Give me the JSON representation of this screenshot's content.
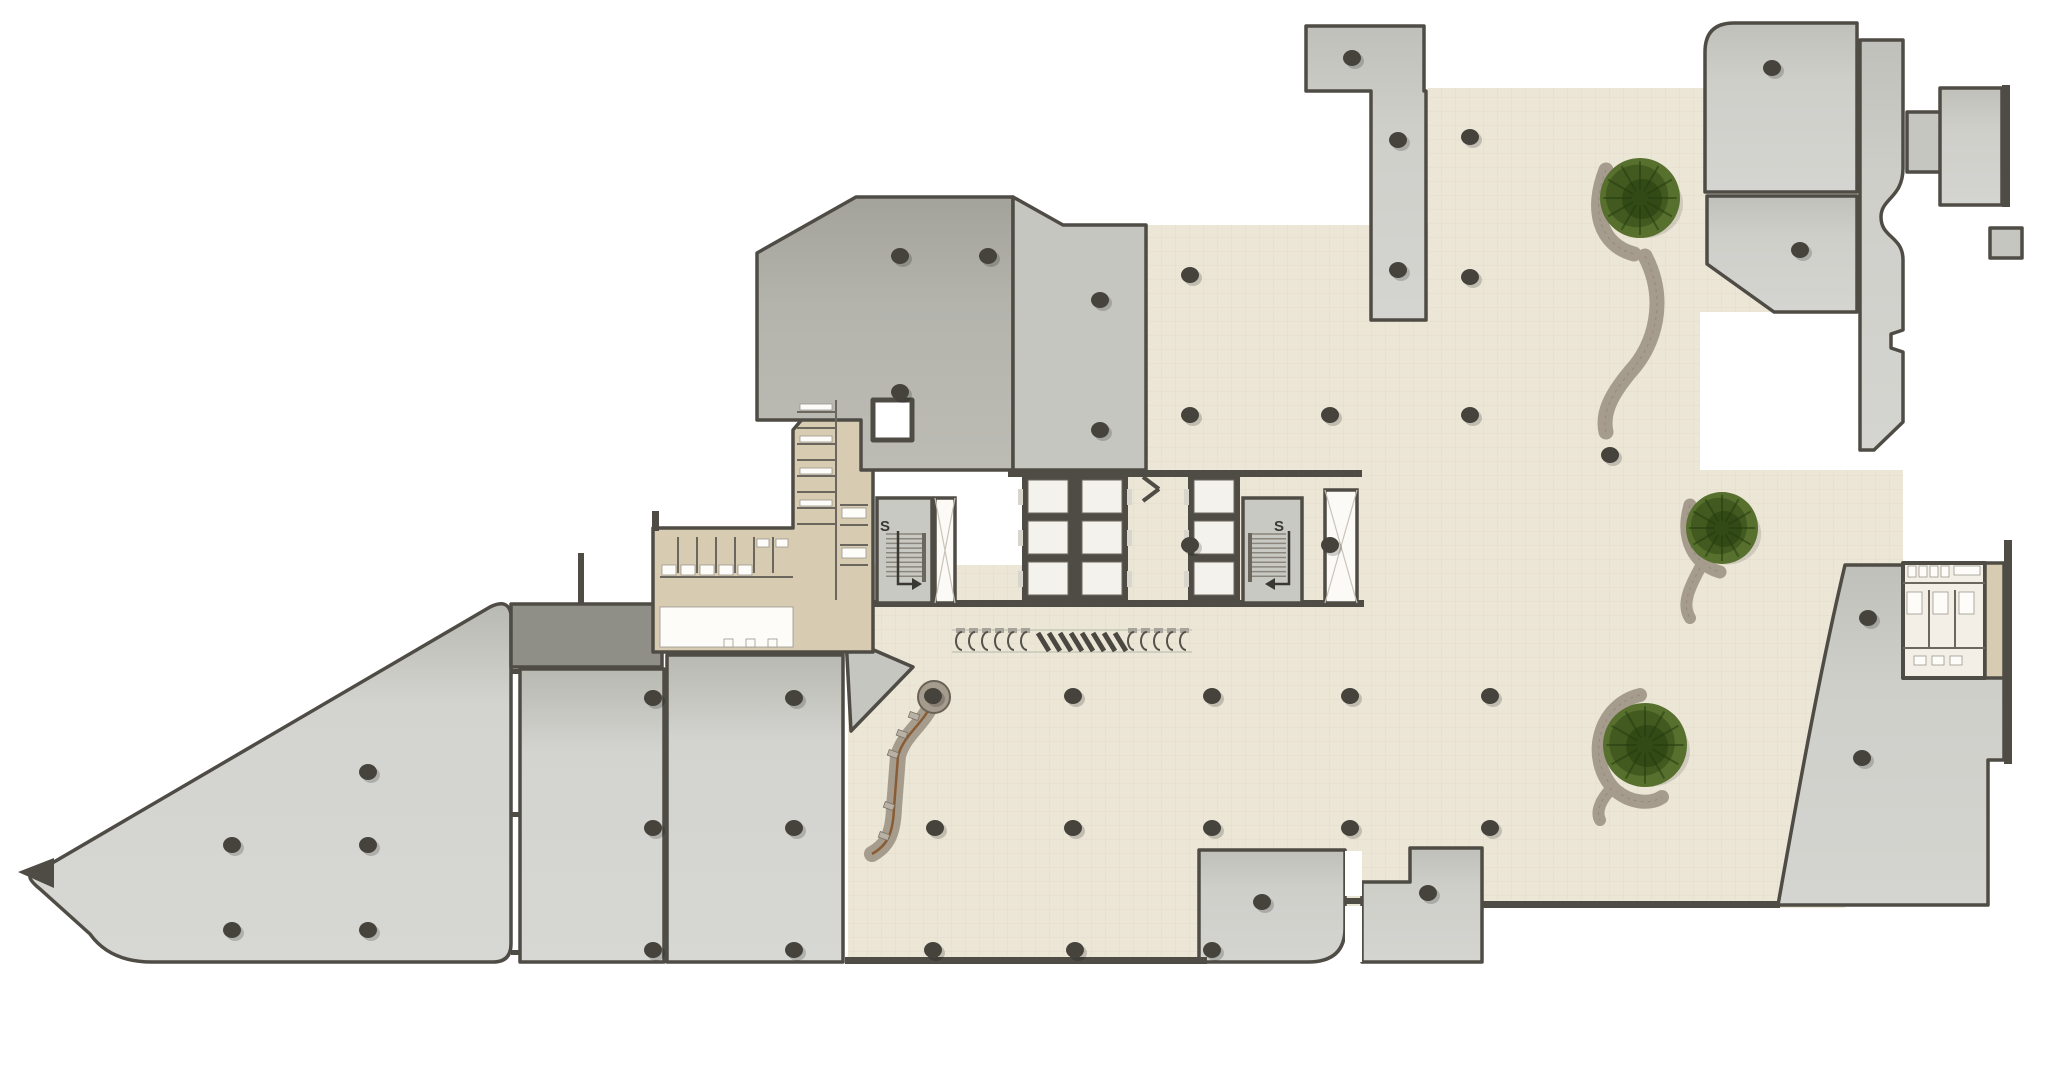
{
  "labels": {
    "stair_left": "S",
    "stair_right": "S"
  },
  "palette": {
    "background": "#ffffff",
    "wall": "#4f4c45",
    "room_light": "#d3d3cf",
    "room_mid": "#c6c6c1",
    "room_dark_band": "#8f8f88",
    "room_top_cluster": "#b4b4ad",
    "beige": "#ece6d7",
    "beige_grid": "#d9d0ba",
    "tan": "#d7cbb2",
    "white_room": "#f3efe6",
    "tree_green_outer": "#57702d",
    "tree_green_mid": "#42591f",
    "tree_green_dark": "#324a15",
    "planter_gray": "#a69c8e",
    "path_brown": "#8a5c33",
    "column": "#45433c"
  },
  "plan": {
    "canvas": {
      "w": 2048,
      "h": 1078
    },
    "floor_zones": [
      {
        "name": "concourse-top-arm",
        "d": "M1146,225 L1428,225 L1428,88 L1700,88 L1700,470 L1146,470 Z"
      },
      {
        "name": "concourse-top-right",
        "d": "M1700,88 L1857,88 L1857,312 L1700,312 Z"
      },
      {
        "name": "concourse-mid-band",
        "d": "M1128,470 L1903,470 L1903,565 L1128,565 Z"
      },
      {
        "name": "concourse-core-gap-1",
        "d": "M1128,565 L1188,565 L1188,605 L1128,605 Z"
      },
      {
        "name": "concourse-core-gap-2",
        "d": "M1302,565 L1325,565 L1325,605 L1302,605 Z"
      },
      {
        "name": "concourse-gate-strip",
        "d": "M843,603 L1199,603 L1199,655 L843,655 Z"
      },
      {
        "name": "concourse-main",
        "d": "M848,565 L1845,565 L1845,908 L848,908 Z"
      },
      {
        "name": "concourse-south",
        "d": "M848,655 L1199,655 L1199,958 L848,958 Z"
      }
    ],
    "rooms": [
      {
        "name": "room-triangle-hall",
        "fill": "grad1",
        "d": "M30,876 L490,607 Q508,598 511,614 L511,944 Q511,962 493,962 L152,962 Q110,962 90,934 L40,889 Q29,880 30,876 Z"
      },
      {
        "name": "triangle-tip-wall",
        "fill": "wall",
        "sw": 0,
        "d": "M18,872 L54,858 L54,888 Z"
      },
      {
        "name": "room-dark-band",
        "fill": "dark_band",
        "d": "M511,604 L662,604 L662,667 L511,667 Z"
      },
      {
        "name": "room-a",
        "fill": "grad1",
        "d": "M520,669 L664,669 L664,962 L520,962 Z"
      },
      {
        "name": "room-b",
        "fill": "grad1",
        "d": "M667,655 L843,655 L843,962 L667,962 Z"
      },
      {
        "name": "room-sliver-point",
        "fill": "room_mid",
        "d": "M846,638 L913,667 L851,731 Z"
      },
      {
        "name": "room-restroom-left-block",
        "fill": "tan",
        "d": "M653,528 L793,528 L793,430 L820,398 L873,398 L873,652 L653,652 Z"
      },
      {
        "name": "room-top-cluster-main",
        "fill": "grad2",
        "d": "M757,253 L856,197 L1013,197 L1013,470 L861,470 L861,420 L757,420 Z"
      },
      {
        "name": "room-top-cluster-right",
        "fill": "room_mid",
        "d": "M1013,197 L1063,225 L1146,225 L1146,470 L1013,470 Z"
      },
      {
        "name": "room-tower-slab",
        "fill": "grad3",
        "d": "M1306,26 L1424,26 L1424,91 L1426,91 L1426,320 L1371,320 L1371,91 L1306,91 Z"
      },
      {
        "name": "room-northeast-1",
        "fill": "grad3",
        "d": "M1705,52 Q1705,23 1734,23 L1857,23 L1857,192 L1705,192 Z"
      },
      {
        "name": "room-northeast-2",
        "fill": "grad3",
        "d": "M1707,196 L1857,196 L1857,312 L1774,312 L1707,264 Z"
      },
      {
        "name": "room-east-violin",
        "fill": "grad3",
        "d": "M1860,40 L1903,40 L1903,168 C1903,198 1881,198 1881,217 C1881,238 1903,236 1903,260 L1903,330 L1891,334 L1891,348 L1903,352 L1903,422 L1874,450 L1860,450 Z"
      },
      {
        "name": "room-east-headbox",
        "fill": "room_mid",
        "d": "M1907,112 L1942,112 L1942,172 L1907,172 Z"
      },
      {
        "name": "room-far-right-top",
        "fill": "grad3",
        "d": "M1940,88 L2002,88 L2002,205 L1940,205 Z"
      },
      {
        "name": "room-far-right-box",
        "fill": "room_mid",
        "d": "M1990,228 L2022,228 L2022,258 L1990,258 Z"
      },
      {
        "name": "room-southeast-curved",
        "fill": "grad3",
        "d": "M1845,565 L2004,565 L2004,760 L1988,760 L1988,905 L1778,905 C1802,770 1822,662 1845,565 Z"
      },
      {
        "name": "room-south-1",
        "fill": "grad3",
        "d": "M1199,850 L1345,850 L1345,928 Q1345,962 1308,962 L1199,962 Z"
      },
      {
        "name": "room-south-2",
        "fill": "grad3",
        "d": "M1362,882 L1410,882 L1410,848 L1482,848 L1482,962 L1362,962 Z"
      },
      {
        "name": "room-restroom-right-block",
        "fill": "white_room",
        "sw": 4,
        "d": "M1903,563 L1985,563 L1985,678 L1903,678 Z"
      },
      {
        "name": "room-restroom-right-strip",
        "fill": "tan",
        "d": "M1985,563 L2004,563 L2004,678 L1985,678 Z"
      },
      {
        "name": "room-elevator-duct-box",
        "fill": "white",
        "sw": 5,
        "d": "M873,400 L912,400 L912,440 L873,440 Z"
      }
    ],
    "walls": [
      [
        872,
        600,
        492,
        7
      ],
      [
        845,
        957,
        362,
        7
      ],
      [
        1482,
        901,
        298,
        7
      ],
      [
        578,
        553,
        6,
        51
      ],
      [
        652,
        511,
        7,
        20
      ],
      [
        2002,
        85,
        8,
        122
      ],
      [
        2004,
        540,
        8,
        224
      ],
      [
        1008,
        470,
        354,
        7
      ],
      [
        511,
        669,
        9,
        5
      ],
      [
        511,
        812,
        9,
        5
      ],
      [
        511,
        950,
        9,
        5
      ],
      [
        1345,
        898,
        17,
        6
      ]
    ],
    "white_rects": [
      [
        1345,
        851,
        17,
        45
      ],
      [
        1345,
        906,
        17,
        56
      ]
    ],
    "fixture_lines": [
      [
        678,
        537,
        678,
        573
      ],
      [
        697,
        537,
        697,
        573
      ],
      [
        716,
        537,
        716,
        573
      ],
      [
        735,
        537,
        735,
        573
      ],
      [
        754,
        537,
        754,
        573
      ],
      [
        773,
        537,
        773,
        573
      ],
      [
        660,
        577,
        793,
        577
      ],
      [
        797,
        412,
        836,
        412
      ],
      [
        797,
        428,
        836,
        428
      ],
      [
        797,
        444,
        836,
        444
      ],
      [
        797,
        460,
        836,
        460
      ],
      [
        797,
        476,
        836,
        476
      ],
      [
        797,
        492,
        836,
        492
      ],
      [
        797,
        508,
        836,
        508
      ],
      [
        797,
        524,
        836,
        524
      ],
      [
        836,
        400,
        836,
        600
      ],
      [
        840,
        505,
        868,
        505
      ],
      [
        840,
        525,
        868,
        525
      ],
      [
        840,
        545,
        868,
        545
      ],
      [
        840,
        565,
        868,
        565
      ],
      [
        1903,
        583,
        1985,
        583
      ],
      [
        1903,
        648,
        1985,
        648
      ],
      [
        1929,
        590,
        1929,
        648
      ],
      [
        1955,
        590,
        1955,
        648
      ]
    ],
    "fixtures_white": [
      [
        662,
        565,
        14,
        10
      ],
      [
        681,
        565,
        14,
        10
      ],
      [
        700,
        565,
        14,
        10
      ],
      [
        719,
        565,
        14,
        10
      ],
      [
        738,
        565,
        14,
        10
      ],
      [
        757,
        539,
        12,
        8
      ],
      [
        776,
        539,
        12,
        8
      ],
      [
        660,
        607,
        133,
        40
      ],
      [
        724,
        639,
        9,
        8
      ],
      [
        746,
        639,
        9,
        8
      ],
      [
        768,
        639,
        9,
        8
      ],
      [
        800,
        404,
        32,
        6
      ],
      [
        800,
        436,
        32,
        6
      ],
      [
        800,
        468,
        32,
        6
      ],
      [
        800,
        500,
        32,
        6
      ],
      [
        842,
        508,
        24,
        10
      ],
      [
        842,
        548,
        24,
        10
      ],
      [
        1908,
        566,
        8,
        11
      ],
      [
        1919,
        566,
        8,
        11
      ],
      [
        1930,
        566,
        8,
        11
      ],
      [
        1941,
        566,
        8,
        11
      ],
      [
        1954,
        566,
        26,
        9
      ],
      [
        1907,
        592,
        15,
        22
      ],
      [
        1933,
        592,
        15,
        22
      ],
      [
        1959,
        592,
        15,
        22
      ],
      [
        1914,
        656,
        12,
        9
      ],
      [
        1932,
        656,
        12,
        9
      ],
      [
        1950,
        656,
        12,
        9
      ]
    ],
    "stairs": [
      {
        "name": "stair-left",
        "room": [
          877,
          498,
          55,
          105
        ],
        "treads_x": [
          886,
          926
        ],
        "rail_x": 922,
        "arrow_x": 898,
        "dir": 1
      },
      {
        "name": "stair-right",
        "room": [
          1243,
          498,
          59,
          105
        ],
        "treads_x": [
          1248,
          1286
        ],
        "rail_x": 1248,
        "arrow_x": 1289,
        "dir": -1
      }
    ],
    "shafts": [
      {
        "name": "shaft-left",
        "rect": [
          935,
          498,
          20,
          105
        ]
      },
      {
        "name": "shaft-right",
        "rect": [
          1325,
          490,
          32,
          113
        ]
      }
    ],
    "elevator_banks": [
      {
        "name": "elevator-bank-center",
        "x": 1022,
        "y": 473,
        "w": 106,
        "h": 130,
        "cols": 2,
        "rows": 3,
        "doors": "both"
      },
      {
        "name": "elevator-bank-east",
        "x": 1188,
        "y": 473,
        "w": 52,
        "h": 130,
        "cols": 1,
        "rows": 3,
        "doors": "left"
      }
    ],
    "chevron_wall": [
      [
        1143,
        477,
        1159,
        489
      ],
      [
        1159,
        489,
        1143,
        501
      ]
    ],
    "turnstiles": {
      "guide_y": [
        630,
        652
      ],
      "guide_x": [
        952,
        1192
      ],
      "gates_left": {
        "start": 956,
        "count": 6,
        "step": 13,
        "y": 630
      },
      "blades": {
        "start": 1038,
        "count": 8,
        "step": 11,
        "y": 633
      },
      "gates_right": {
        "start": 1128,
        "count": 5,
        "step": 13,
        "y": 630
      }
    },
    "trees": [
      {
        "name": "tree-north",
        "x": 1640,
        "y": 198,
        "r": 40
      },
      {
        "name": "tree-mid",
        "x": 1722,
        "y": 528,
        "r": 36
      },
      {
        "name": "tree-south",
        "x": 1645,
        "y": 745,
        "r": 42
      }
    ],
    "planter_paths": [
      {
        "name": "planter-north-arc",
        "d": "M1606,170 C1590,210 1600,245 1634,254",
        "w": 15
      },
      {
        "name": "planter-north-tail",
        "d": "M1645,256 C1668,300 1655,345 1630,372 C1610,396 1602,414 1606,432",
        "w": 15
      },
      {
        "name": "planter-mid-arc",
        "d": "M1690,505 C1680,540 1695,565 1720,572",
        "w": 13
      },
      {
        "name": "planter-mid-tail",
        "d": "M1700,568 C1688,590 1682,605 1690,618",
        "w": 12
      },
      {
        "name": "planter-south-arc",
        "d": "M1640,695 C1598,705 1585,760 1615,790 C1630,803 1650,805 1662,797",
        "w": 14
      },
      {
        "name": "planter-south-tail",
        "d": "M1612,788 C1600,800 1596,812 1600,820",
        "w": 12
      }
    ],
    "ramp": {
      "hub": {
        "x": 934,
        "y": 697,
        "r_outer": 16,
        "r_inner": 7
      },
      "path_d": "M934,700 C922,726 904,734 898,756 L894,808 C893,836 886,846 872,854",
      "benches": [
        [
          914,
          716
        ],
        [
          902,
          734
        ],
        [
          893,
          754
        ],
        [
          889,
          806
        ],
        [
          884,
          836
        ]
      ]
    },
    "columns": [
      [
        368,
        772
      ],
      [
        232,
        845
      ],
      [
        368,
        845
      ],
      [
        232,
        930
      ],
      [
        368,
        930
      ],
      [
        653,
        698
      ],
      [
        794,
        698
      ],
      [
        653,
        828
      ],
      [
        794,
        828
      ],
      [
        653,
        950
      ],
      [
        794,
        950
      ],
      [
        933,
        696
      ],
      [
        1073,
        696
      ],
      [
        935,
        828
      ],
      [
        1073,
        828
      ],
      [
        933,
        950
      ],
      [
        1075,
        950
      ],
      [
        1212,
        696
      ],
      [
        1212,
        828
      ],
      [
        1212,
        950
      ],
      [
        1350,
        696
      ],
      [
        1490,
        696
      ],
      [
        1350,
        828
      ],
      [
        1490,
        828
      ],
      [
        1190,
        275
      ],
      [
        1190,
        415
      ],
      [
        1190,
        545
      ],
      [
        1470,
        137
      ],
      [
        1470,
        277
      ],
      [
        1330,
        415
      ],
      [
        1470,
        415
      ],
      [
        1330,
        545
      ],
      [
        1610,
        455
      ],
      [
        900,
        256
      ],
      [
        988,
        256
      ],
      [
        1100,
        300
      ],
      [
        900,
        392
      ],
      [
        1100,
        430
      ],
      [
        1352,
        58
      ],
      [
        1398,
        140
      ],
      [
        1398,
        270
      ],
      [
        1772,
        68
      ],
      [
        1800,
        250
      ],
      [
        1862,
        758
      ],
      [
        1868,
        618
      ],
      [
        1262,
        902
      ],
      [
        1428,
        893
      ]
    ],
    "stair_label_pos": [
      [
        880,
        531
      ],
      [
        1274,
        531
      ]
    ]
  }
}
